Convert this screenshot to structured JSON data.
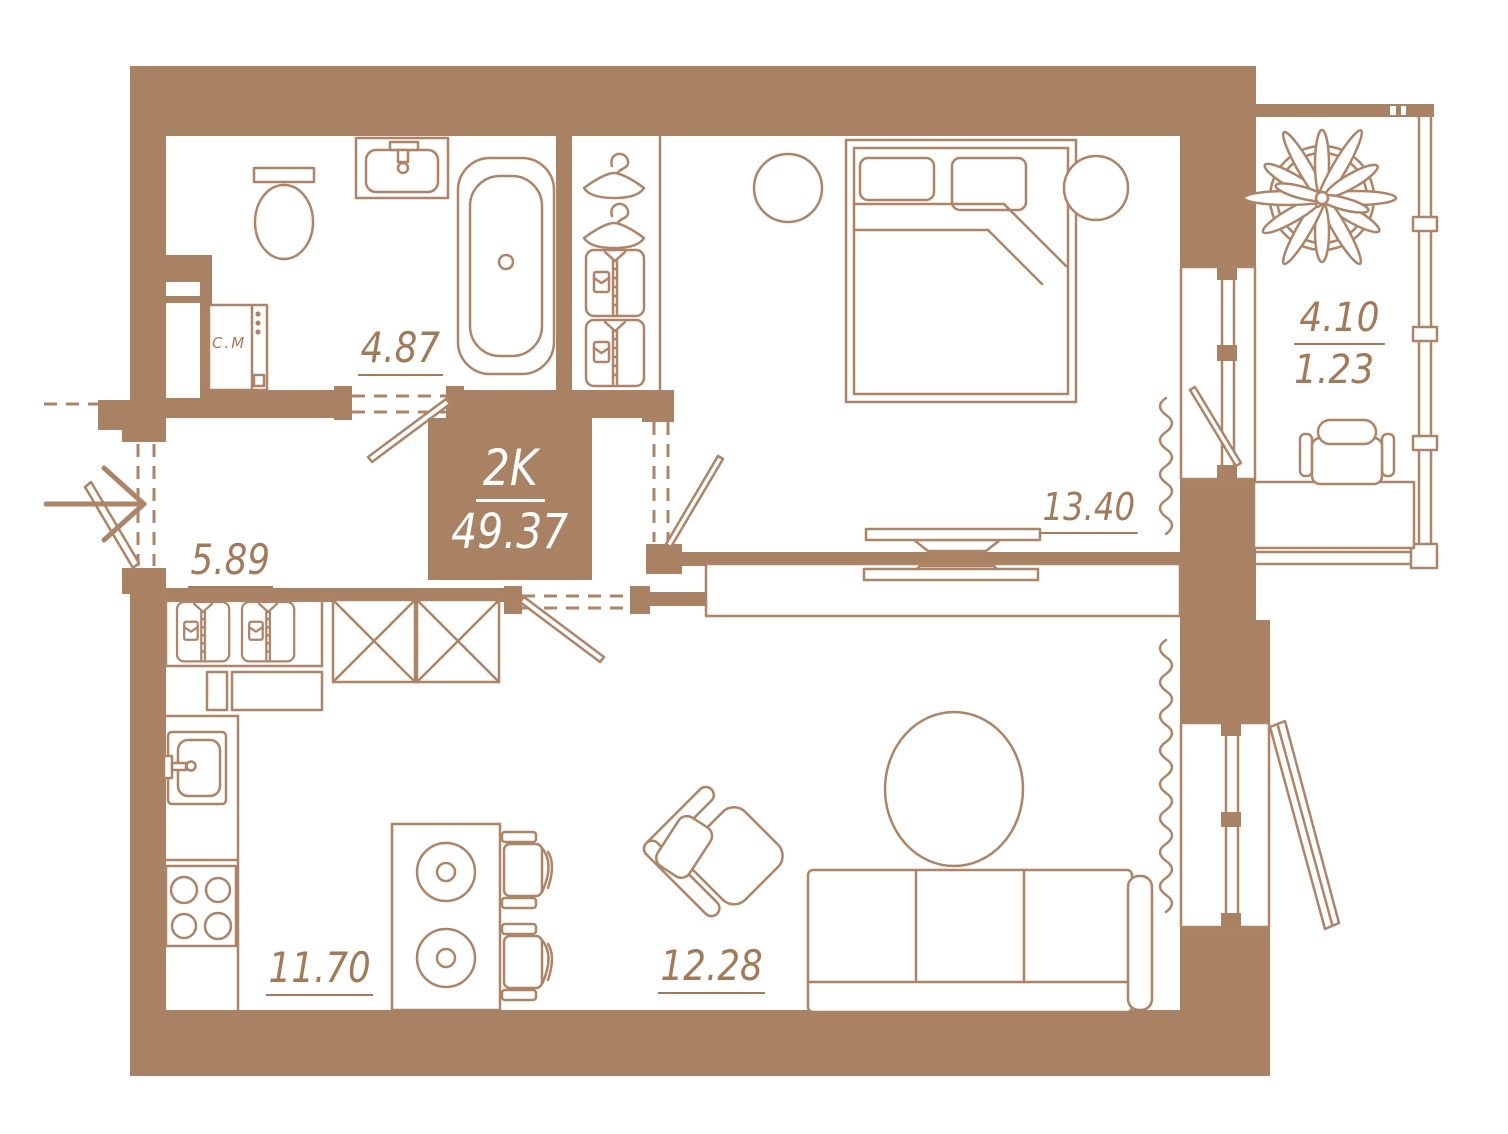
{
  "plan": {
    "unit": {
      "type_label": "2K",
      "total_area": "49.37"
    },
    "rooms": [
      {
        "id": "bathroom",
        "area": "4.87"
      },
      {
        "id": "hallway",
        "area": "5.89"
      },
      {
        "id": "kitchen",
        "area": "11.70"
      },
      {
        "id": "living-room",
        "area": "12.28"
      },
      {
        "id": "bedroom",
        "area": "13.40"
      },
      {
        "id": "balcony",
        "area_full": "4.10",
        "area_reduced": "1.23"
      }
    ],
    "appliances": {
      "washing_machine_label": "С.М"
    }
  },
  "colors": {
    "wall": "#a98264",
    "line": "#ad8566",
    "ink": "#a27a58",
    "background": "#ffffff"
  }
}
